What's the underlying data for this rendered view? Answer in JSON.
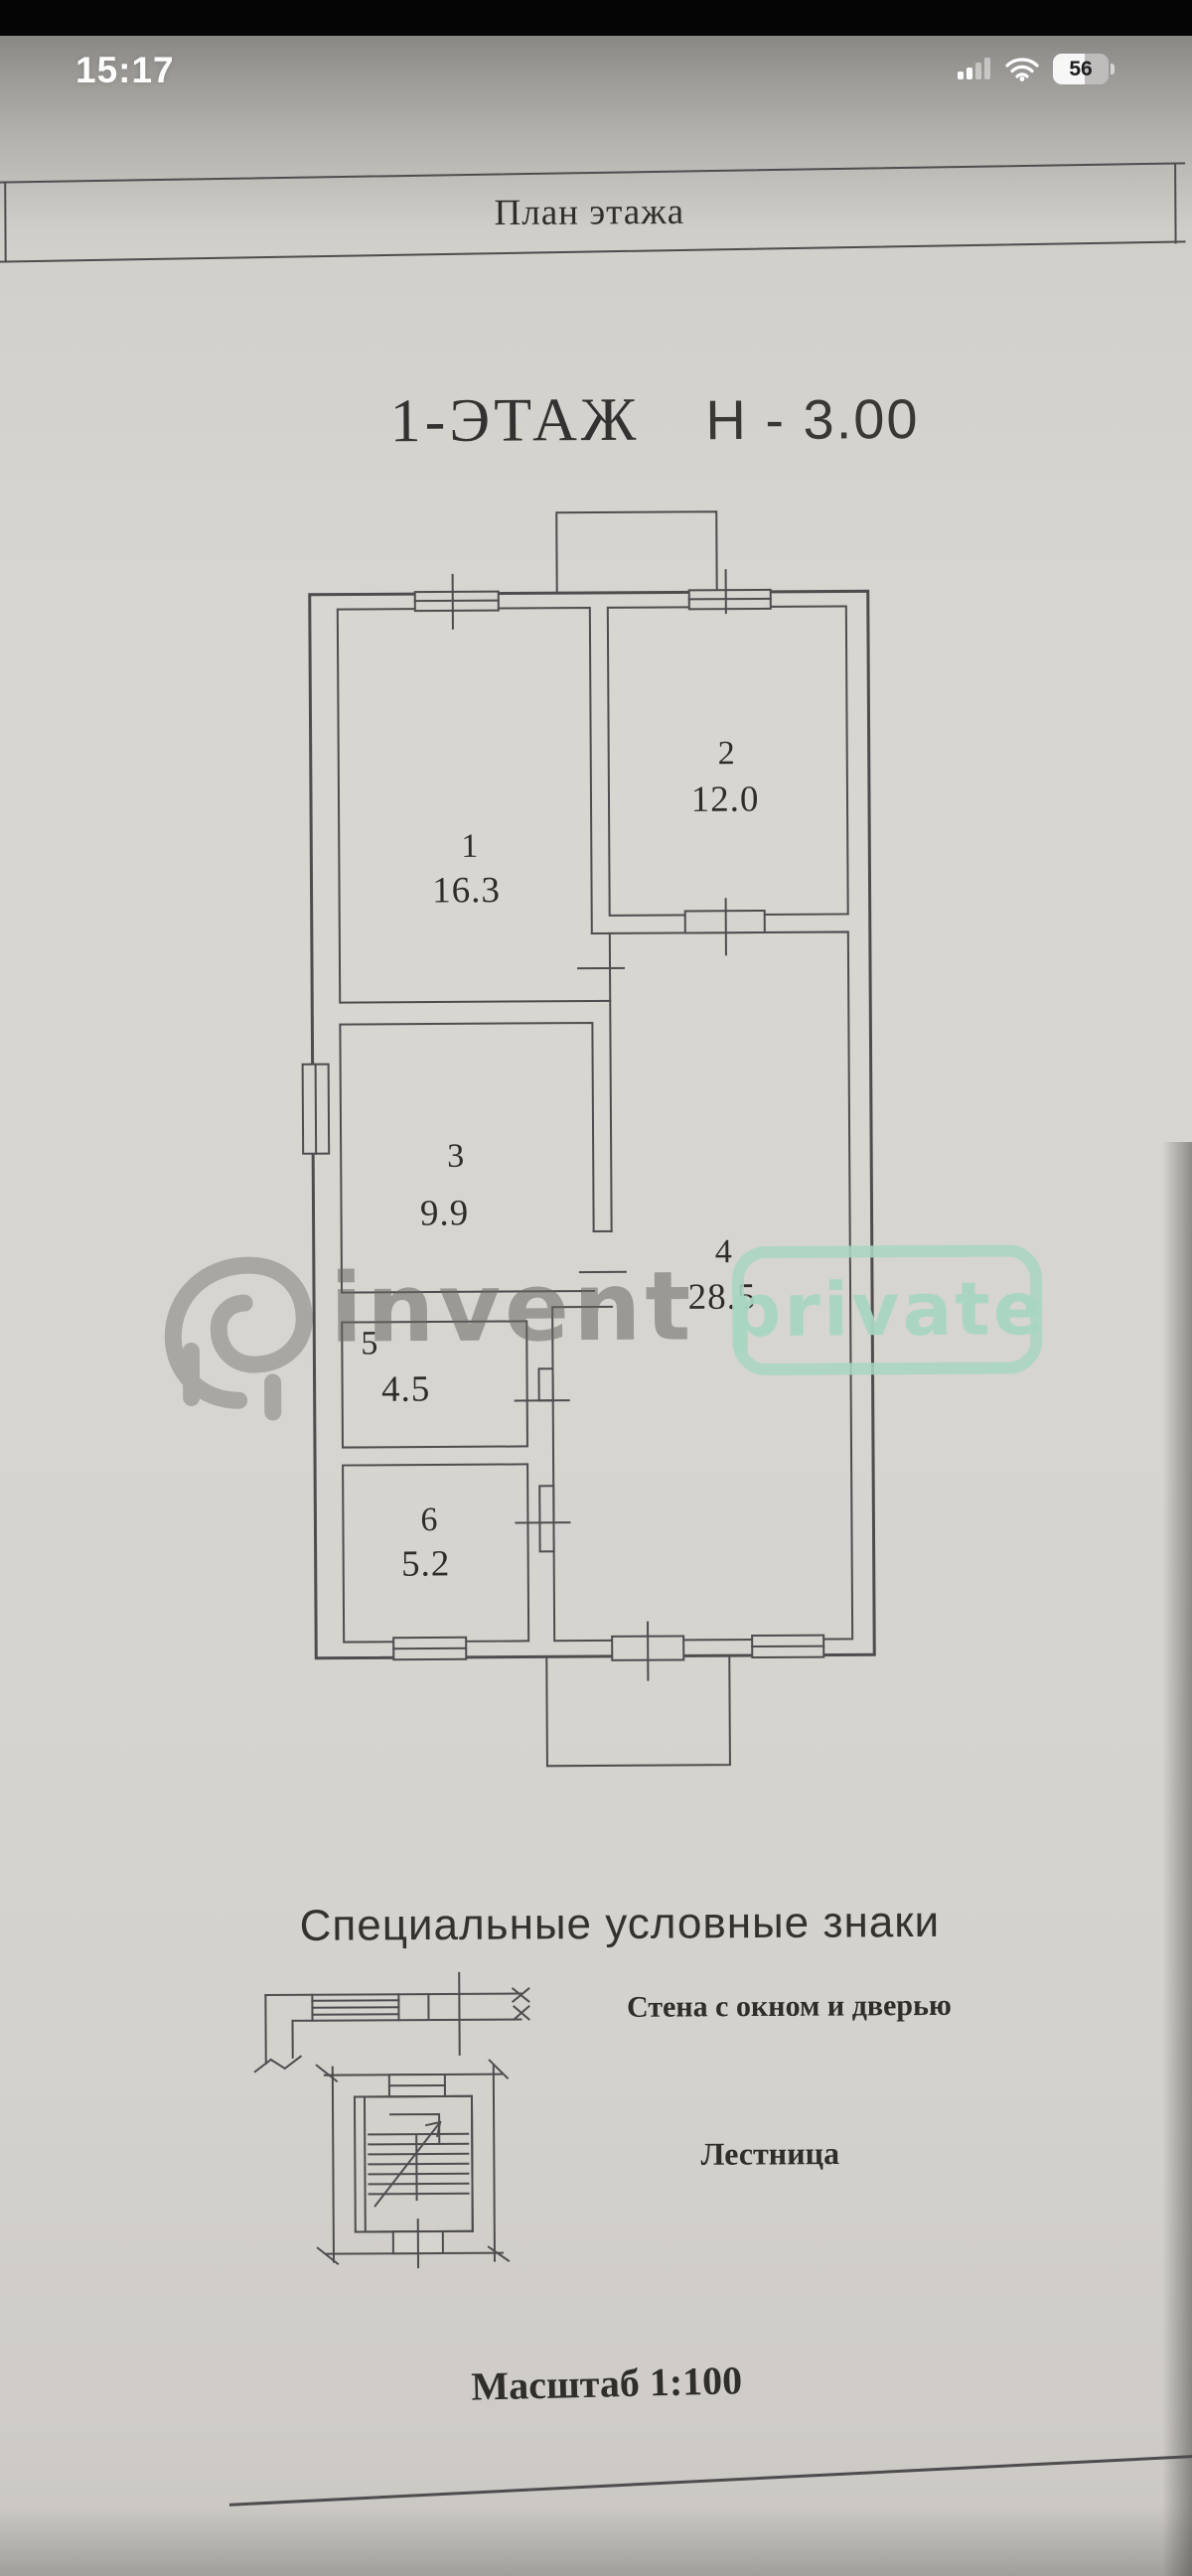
{
  "status_bar": {
    "time": "15:17",
    "battery_percent": "56"
  },
  "doc": {
    "header_title": "План этажа",
    "floor_label": "1-ЭТАЖ",
    "height_label": "Н - 3.00",
    "legend_heading": "Специальные условные знаки",
    "wall_symbol_label": "Стена с окном и дверью",
    "stairs_symbol_label": "Лестница",
    "scale_label": "Масштаб 1:100"
  },
  "rooms": [
    {
      "number": "1",
      "area": "16.3"
    },
    {
      "number": "2",
      "area": "12.0"
    },
    {
      "number": "3",
      "area": "9.9"
    },
    {
      "number": "4",
      "area": "28.5"
    },
    {
      "number": "5",
      "area": "4.5"
    },
    {
      "number": "6",
      "area": "5.2"
    }
  ],
  "watermark": {
    "brand": "invent",
    "badge": "private",
    "brand_color": "#6c6b67",
    "badge_color": "#a8d6c0"
  },
  "colors": {
    "plan_line": "#4e4c4e",
    "paper": "#d6d4cf",
    "text": "#302e2b"
  }
}
